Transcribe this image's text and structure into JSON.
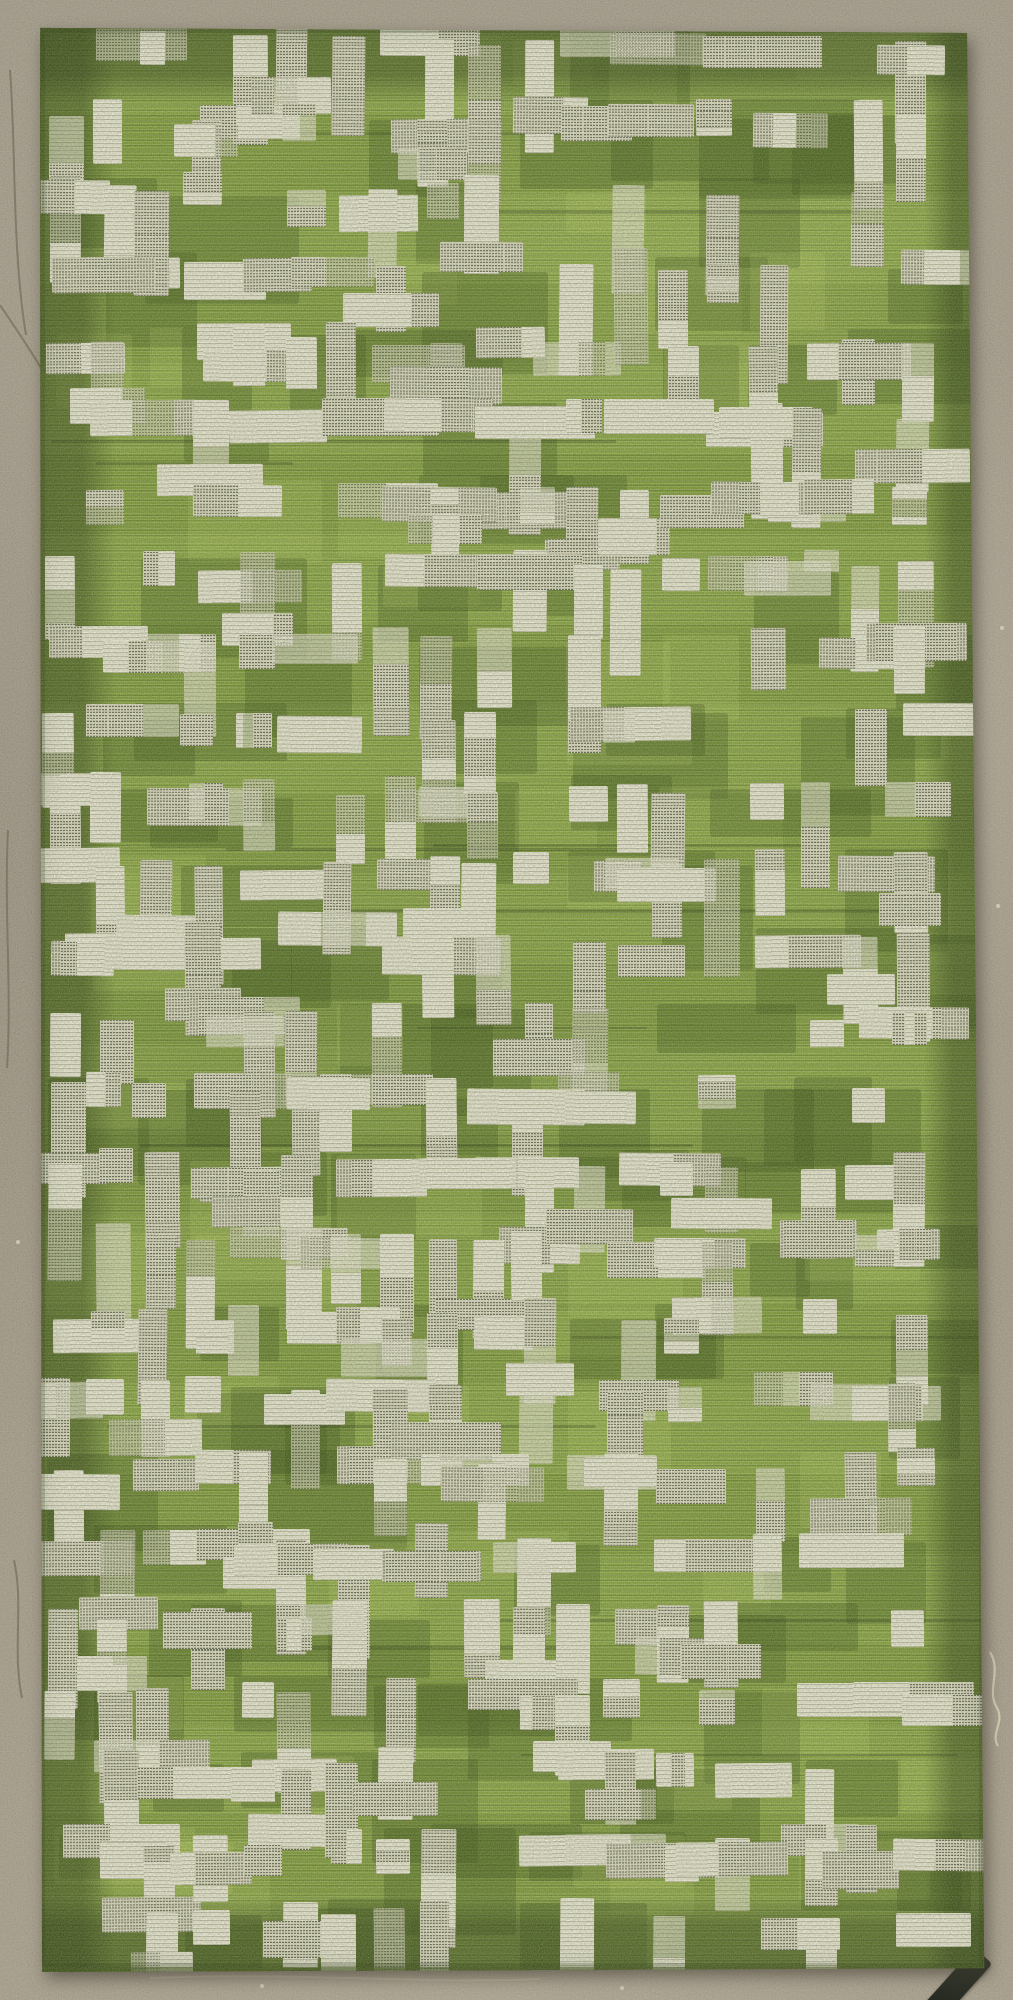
{
  "scene": {
    "type": "photograph",
    "description": "Green and white patterned flat-woven textile (rug / fabric panel) with a broken-grid motif of cream vertical bars and hatched crossbars, darker olive border band, lying on a speckled taupe concrete floor. Small dark strap at bottom-right corner, loose pale thread on the concrete at right.",
    "canvas": {
      "width": 1013,
      "height": 2000
    }
  },
  "floor": {
    "base_color": "#9a9180",
    "shade_dark": "#6f6757",
    "shade_light": "#b6ad99",
    "crack_color": "#756d5c",
    "scratch_color": "#bdb5a0",
    "pebble_color": "#d8d0ba",
    "cracks": [
      "M10,70 C16,150 12,250 26,335",
      "M0,305 C18,332 32,352 42,370",
      "M8,830 C4,915 12,990 7,1068",
      "M14,1560 C24,1606 12,1650 22,1698"
    ],
    "scratches": [
      "M150,1978 C300,1972 420,1984 540,1979",
      "M700,40 C760,44 830,38 890,42"
    ],
    "pebbles": [
      [
        372,
        52
      ],
      [
        700,
        57
      ],
      [
        948,
        252
      ],
      [
        18,
        1242
      ],
      [
        998,
        906
      ],
      [
        262,
        1986
      ],
      [
        622,
        1988
      ],
      [
        64,
        438
      ],
      [
        1002,
        628
      ],
      [
        86,
        1120
      ]
    ]
  },
  "thread": {
    "path": "M990,1652 C1002,1672 986,1690 997,1708 C1005,1722 990,1734 998,1746",
    "color": "#d8cfb6"
  },
  "strap": {
    "left": 946,
    "top": 1946,
    "width": 24,
    "height": 76,
    "rotate_deg": 42,
    "color_a": "#3d4134",
    "color_b": "#1e221a"
  },
  "textile": {
    "bounds": {
      "left": 36,
      "top": 24,
      "width": 952,
      "height": 1948
    },
    "clip_polygon": "polygon(0.42% 0.2%, 97.8% 0.46%, 99.6% 99.8%, 0.63% 100%)",
    "field_color": "#7e9b30",
    "cream_color": "#ece8d7",
    "band_color": "rgba(30,46,8,0.46)",
    "bands": {
      "top": 80,
      "bottom": 78,
      "left": 80,
      "right": 64
    },
    "pattern": {
      "seed": 11,
      "col_pitch": 47,
      "row_pitch": 75,
      "margin_x": 12,
      "margin_y": 10,
      "jitter_x": 10,
      "jitter_y": 12,
      "v_bar": {
        "width": 32,
        "min_h": 62,
        "max_h": 120,
        "prob": 0.38
      },
      "h_bar": {
        "height": 34,
        "min_w": 62,
        "max_w": 122,
        "prob": 0.2
      },
      "square": {
        "size": 35,
        "prob": 0.12
      },
      "crossbar_prob": 0.5,
      "hatch_prob": 0.48,
      "faded_prob": 0.22,
      "rotate_max_deg": 1.4,
      "olive_patch": {
        "prob": 0.22,
        "color": "rgba(48,68,14,0.30)",
        "min_w": 56,
        "max_w": 170,
        "min_h": 44,
        "max_h": 108
      },
      "light_patch": {
        "prob": 0.1,
        "color": "rgba(214,232,118,0.16)",
        "min_w": 60,
        "max_w": 150,
        "min_h": 40,
        "max_h": 90
      },
      "streaks": {
        "count": 14,
        "color": "rgba(18,32,4,0.26)",
        "min_w": 180,
        "max_w": 600,
        "min_h": 2,
        "max_h": 4
      }
    }
  },
  "palette": {
    "bright_green": "#8fac3b",
    "mid_green": "#7e9b30",
    "olive_border": "#5c7424",
    "cream": "#ece8d7",
    "stitch_dark": "#3e4334",
    "concrete": "#9a9180"
  }
}
